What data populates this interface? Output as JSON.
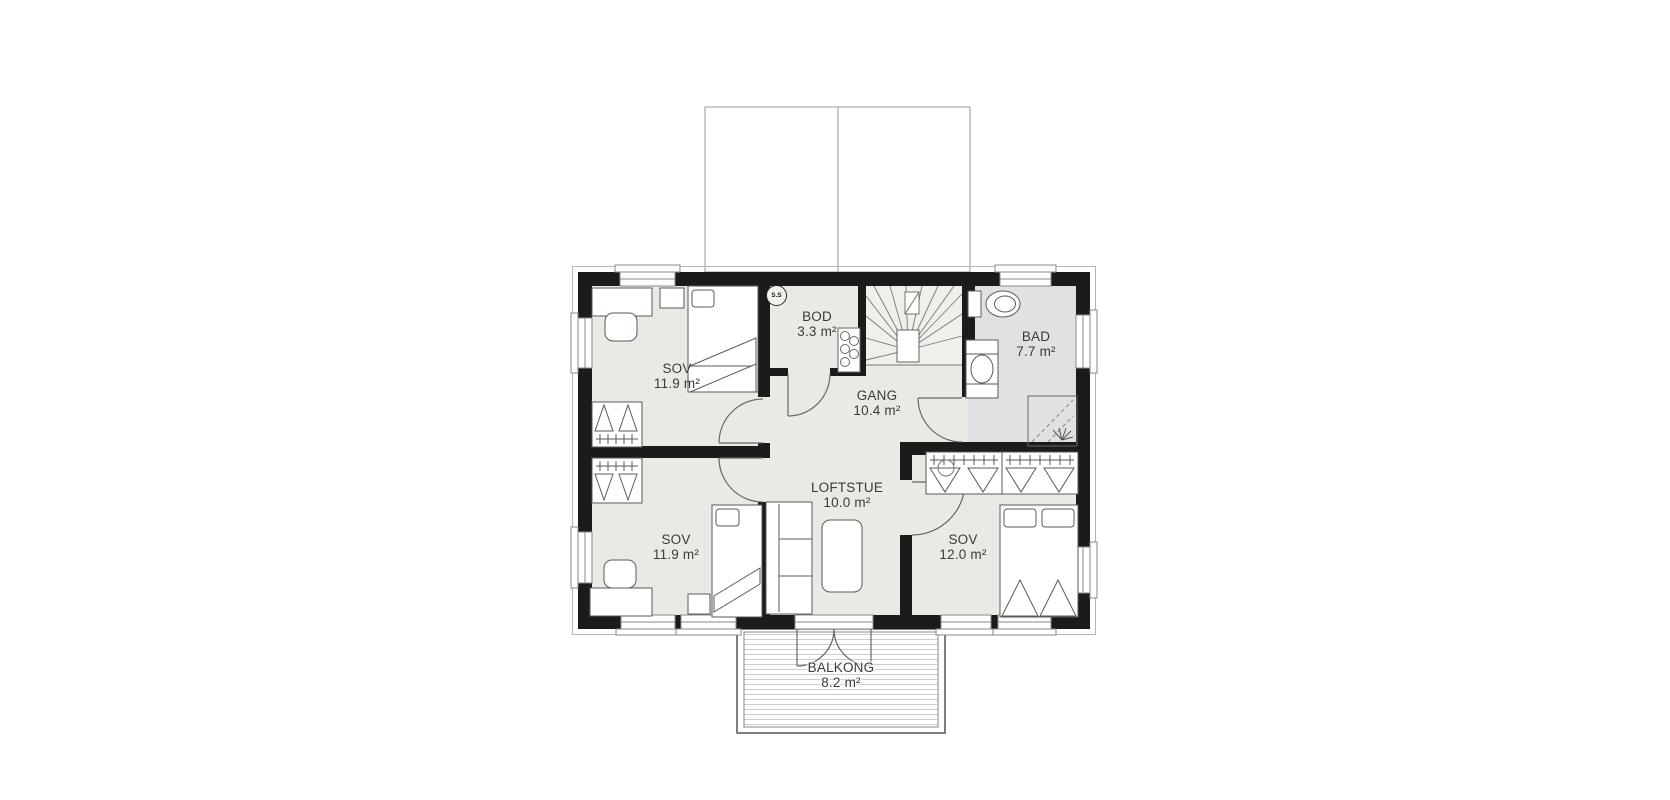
{
  "floorplan": {
    "colors": {
      "wall": "#1b1b1b",
      "floor": "#eaeae5",
      "bath_floor": "#e0e1e3",
      "stair_floor": "#f0f0eb",
      "outline": "#b5b5b5",
      "furniture_line": "#5a5a5a",
      "label_text": "#3a3a3a",
      "deck_line": "#cccccc"
    },
    "rooms": [
      {
        "id": "sov-1",
        "name": "SOV",
        "area": "11.9 m²"
      },
      {
        "id": "bod",
        "name": "BOD",
        "area": "3.3 m²"
      },
      {
        "id": "bad",
        "name": "BAD",
        "area": "7.7 m²"
      },
      {
        "id": "gang",
        "name": "GANG",
        "area": "10.4 m²"
      },
      {
        "id": "sov-2",
        "name": "SOV",
        "area": "11.9 m²"
      },
      {
        "id": "loftstue",
        "name": "LOFTSTUE",
        "area": "10.0 m²"
      },
      {
        "id": "sov-3",
        "name": "SOV",
        "area": "12.0 m²"
      },
      {
        "id": "balkong",
        "name": "BALKONG",
        "area": "8.2 m²"
      }
    ],
    "markers": {
      "smoke_detector": "S.S"
    }
  }
}
